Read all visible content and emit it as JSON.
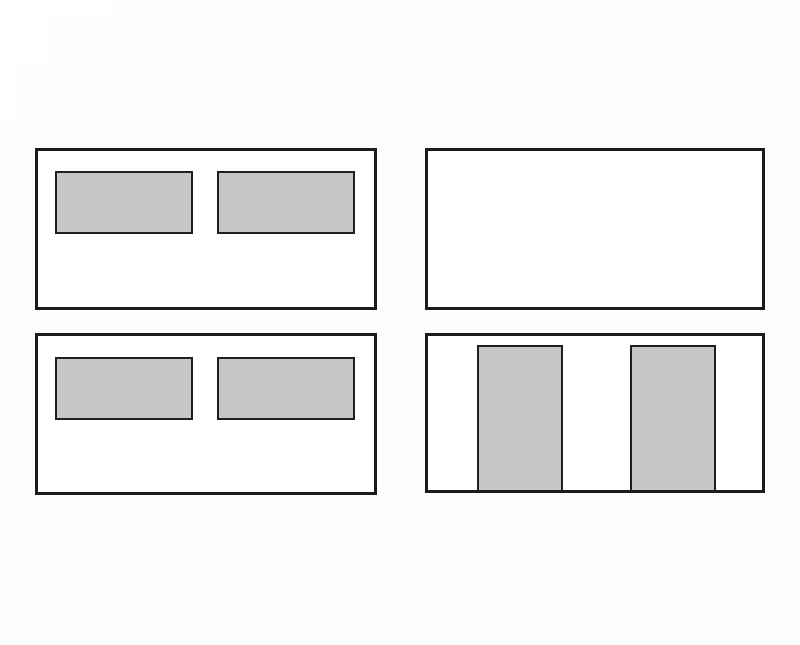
{
  "canvas": {
    "width": 800,
    "height": 645,
    "background": "#fdfdfd"
  },
  "colors": {
    "panel_fill": "#ffffff",
    "panel_border": "#1c1c1c",
    "rect_fill": "#c6c6c6",
    "rect_border": "#1f1f1f",
    "artifact_fill": "#ffffff"
  },
  "corner_artifact": {
    "rects": [
      {
        "id": "corner-artifact-strip-top",
        "x": 0,
        "y": 0,
        "w": 112,
        "h": 15
      },
      {
        "id": "corner-artifact-strip-mid",
        "x": 0,
        "y": 0,
        "w": 48,
        "h": 63
      },
      {
        "id": "corner-artifact-strip-left",
        "x": 0,
        "y": 0,
        "w": 15,
        "h": 123
      }
    ]
  },
  "panels": [
    {
      "id": "panel-top-left",
      "x": 35,
      "y": 148,
      "w": 342,
      "h": 162,
      "border_width": 3,
      "children": [
        {
          "id": "inner-rect-1",
          "x": 17,
          "y": 20,
          "w": 138,
          "h": 63,
          "border_width": 2,
          "attach_bottom": false
        },
        {
          "id": "inner-rect-2",
          "x": 179,
          "y": 20,
          "w": 138,
          "h": 63,
          "border_width": 2,
          "attach_bottom": false
        }
      ]
    },
    {
      "id": "panel-top-right",
      "x": 425,
      "y": 148,
      "w": 340,
      "h": 162,
      "border_width": 3,
      "children": []
    },
    {
      "id": "panel-bottom-left",
      "x": 35,
      "y": 333,
      "w": 342,
      "h": 162,
      "border_width": 3,
      "children": [
        {
          "id": "inner-rect-1",
          "x": 17,
          "y": 21,
          "w": 138,
          "h": 63,
          "border_width": 2,
          "attach_bottom": false
        },
        {
          "id": "inner-rect-2",
          "x": 179,
          "y": 21,
          "w": 138,
          "h": 63,
          "border_width": 2,
          "attach_bottom": false
        }
      ]
    },
    {
      "id": "panel-bottom-right",
      "x": 425,
      "y": 333,
      "w": 340,
      "h": 160,
      "border_width": 3,
      "children": [
        {
          "id": "tall-rect-1",
          "x": 49,
          "y": 9,
          "w": 86,
          "h": 145,
          "border_width": 2,
          "attach_bottom": true
        },
        {
          "id": "tall-rect-2",
          "x": 202,
          "y": 9,
          "w": 86,
          "h": 145,
          "border_width": 2,
          "attach_bottom": true
        }
      ]
    }
  ]
}
